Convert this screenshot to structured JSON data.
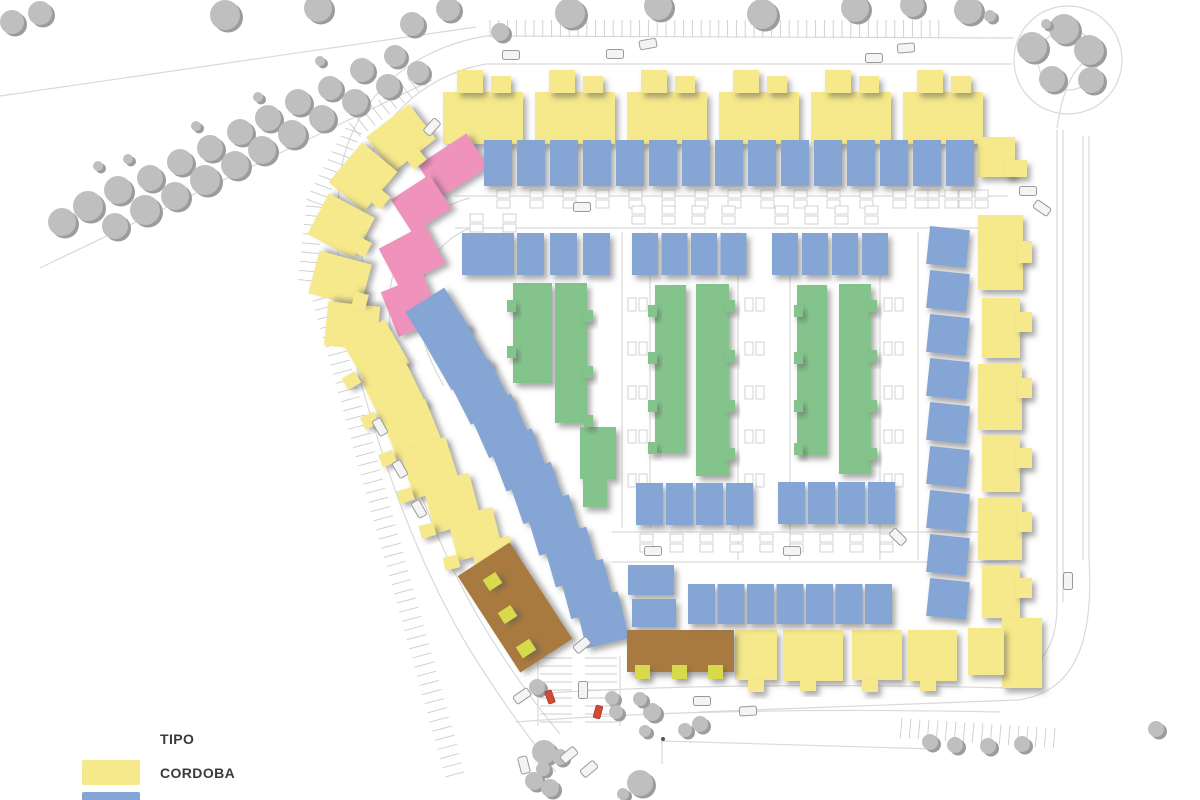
{
  "legend": {
    "title": "TIPO",
    "items": [
      {
        "label": "CORDOBA",
        "color": "#f6e98b"
      },
      {
        "label": "GRANADA",
        "color": "#85a6d4"
      }
    ]
  },
  "palette": {
    "c": "#f6e98b",
    "g": "#85a6d4",
    "v": "#84c48c",
    "p": "#ef93bd",
    "b": "#a87a40",
    "a": "#d6da4c",
    "rojo": "#d14a38",
    "tree": "#bfbfbf",
    "tree_shadow": "#9c9c9c",
    "road": "#d9d9d9",
    "tick": "#cccccc",
    "marker": "#c8c8c8"
  },
  "types": {
    "c": "cordoba-house",
    "g": "granada-house",
    "v": "green-rowhouse",
    "p": "pink-house",
    "b": "brown-community-building",
    "a": "lime-accent"
  },
  "map": {
    "roads": [
      {
        "d": "M 0,96 L 476,27"
      },
      {
        "d": "M 40,268 L 432,80"
      },
      {
        "d": "M 486,36 C 402,50 348,108 340,178 C 334,240 338,300 358,372 C 382,460 418,565 470,650 C 496,692 524,732 556,772"
      },
      {
        "d": "M 486,64 C 420,76 372,124 364,186 C 358,244 362,298 380,366 C 402,450 436,548 486,630 C 508,666 530,698 560,734"
      },
      {
        "d": "M 486,36 L 1014,38"
      },
      {
        "d": "M 486,64 L 1012,64"
      },
      {
        "c": [
          1068,
          60,
          54
        ]
      },
      {
        "c": [
          1068,
          60,
          30
        ]
      },
      {
        "d": "M 1057,128 C 1062,95 1070,75 1082,64"
      },
      {
        "d": "M 1057,130 L 1057,600"
      },
      {
        "d": "M 1063,130 L 1063,602"
      },
      {
        "d": "M 1083,136 L 1083,560"
      },
      {
        "d": "M 1089,136 L 1089,558"
      },
      {
        "d": "M 1057,600 C 1058,640 1046,668 1008,676"
      },
      {
        "d": "M 1089,558 C 1094,640 1076,692 1018,700 L 700,712"
      },
      {
        "d": "M 520,695 C 640,686 800,683 1008,688"
      },
      {
        "d": "M 516,722 C 640,712 800,708 1000,712"
      },
      {
        "d": "M 470,198 C 424,210 396,246 390,290 C 386,330 396,370 416,406"
      },
      {
        "d": "M 476,226 C 444,236 424,262 420,296 C 417,328 426,356 444,386"
      },
      {
        "d": "M 455,196 L 1008,196"
      },
      {
        "d": "M 455,228 L 1008,228"
      },
      {
        "d": "M 622,232 L 622,528"
      },
      {
        "d": "M 650,232 L 650,528"
      },
      {
        "d": "M 738,232 L 738,560"
      },
      {
        "d": "M 790,232 L 790,560"
      },
      {
        "d": "M 880,232 L 880,560"
      },
      {
        "d": "M 918,232 L 918,560"
      },
      {
        "d": "M 612,532 L 1008,532"
      },
      {
        "d": "M 612,562 L 1008,562"
      },
      {
        "d": "M 662,764 L 662,741 L 935,749"
      },
      {
        "d": "M 538,656 L 538,726"
      },
      {
        "d": "M 620,656 L 620,726"
      }
    ],
    "parking": [
      [
        490,
        20,
        52,
        8.8,
        0,
        17,
        90
      ],
      [
        415,
        72,
        10,
        -7.3,
        5.6,
        18,
        52
      ],
      [
        345,
        128,
        10,
        -4.3,
        7.9,
        18,
        20
      ],
      [
        306,
        206,
        9,
        -1.0,
        9.2,
        18,
        5
      ],
      [
        310,
        292,
        54,
        2.55,
        9.15,
        20,
        -15
      ],
      [
        902,
        718,
        18,
        9,
        0.6,
        20,
        95
      ],
      [
        540,
        658,
        9,
        0,
        8,
        32,
        0
      ],
      [
        585,
        658,
        9,
        0,
        8,
        32,
        0
      ]
    ],
    "markers": [
      [
        497,
        190,
        15,
        33,
        "h"
      ],
      [
        470,
        214,
        2,
        33,
        "h"
      ],
      [
        632,
        206,
        4,
        30,
        "h"
      ],
      [
        775,
        206,
        4,
        30,
        "h"
      ],
      [
        628,
        298,
        5,
        44,
        "v"
      ],
      [
        745,
        298,
        5,
        44,
        "v"
      ],
      [
        884,
        298,
        5,
        44,
        "v"
      ],
      [
        640,
        534,
        9,
        30,
        "h"
      ],
      [
        915,
        190,
        3,
        30,
        "h"
      ]
    ],
    "rows": [
      {
        "t": "g",
        "x": 484,
        "y": 140,
        "w": 28,
        "h": 46,
        "n": 15,
        "px": 33
      },
      {
        "t": "g",
        "x": 517,
        "y": 233,
        "w": 27,
        "h": 42,
        "n": 3,
        "px": 33
      },
      {
        "t": "g",
        "x": 632,
        "y": 233,
        "w": 26,
        "h": 42,
        "n": 4,
        "px": 29.5
      },
      {
        "t": "g",
        "x": 772,
        "y": 233,
        "w": 26,
        "h": 42,
        "n": 4,
        "px": 30
      },
      {
        "t": "g",
        "x": 636,
        "y": 483,
        "w": 27,
        "h": 42,
        "n": 4,
        "px": 30
      },
      {
        "t": "g",
        "x": 778,
        "y": 482,
        "w": 27,
        "h": 42,
        "n": 4,
        "px": 30
      },
      {
        "t": "g",
        "x": 688,
        "y": 584,
        "w": 27,
        "h": 40,
        "n": 7,
        "px": 29.5
      },
      {
        "t": "g",
        "x": 928,
        "y": 228,
        "w": 40,
        "h": 38,
        "n": 9,
        "py": 44,
        "rot": 6
      }
    ],
    "buildings": [
      [
        "c",
        443,
        92,
        80,
        52
      ],
      [
        "c",
        457,
        70,
        26,
        23
      ],
      [
        "c",
        491,
        76,
        20,
        17
      ],
      [
        "c",
        535,
        92,
        80,
        52
      ],
      [
        "c",
        549,
        70,
        26,
        23
      ],
      [
        "c",
        583,
        76,
        20,
        17
      ],
      [
        "c",
        627,
        92,
        80,
        52
      ],
      [
        "c",
        641,
        70,
        26,
        23
      ],
      [
        "c",
        675,
        76,
        20,
        17
      ],
      [
        "c",
        719,
        92,
        80,
        52
      ],
      [
        "c",
        733,
        70,
        26,
        23
      ],
      [
        "c",
        767,
        76,
        20,
        17
      ],
      [
        "c",
        811,
        92,
        80,
        52
      ],
      [
        "c",
        825,
        70,
        26,
        23
      ],
      [
        "c",
        859,
        76,
        20,
        17
      ],
      [
        "c",
        903,
        92,
        80,
        52
      ],
      [
        "c",
        917,
        70,
        26,
        23
      ],
      [
        "c",
        951,
        76,
        20,
        17
      ],
      [
        "c",
        978,
        137,
        37,
        40
      ],
      [
        "c",
        1005,
        160,
        22,
        17
      ],
      [
        "c",
        978,
        215,
        45,
        75
      ],
      [
        "c",
        1018,
        241,
        14,
        22
      ],
      [
        "c",
        982,
        298,
        38,
        60
      ],
      [
        "c",
        1016,
        312,
        16,
        20
      ],
      [
        "c",
        978,
        364,
        44,
        66
      ],
      [
        "c",
        1018,
        378,
        14,
        20
      ],
      [
        "c",
        982,
        436,
        38,
        56
      ],
      [
        "c",
        1016,
        448,
        16,
        20
      ],
      [
        "c",
        978,
        498,
        44,
        62
      ],
      [
        "c",
        1018,
        512,
        14,
        20
      ],
      [
        "c",
        982,
        566,
        38,
        52
      ],
      [
        "c",
        1016,
        578,
        16,
        20
      ],
      [
        "c",
        1002,
        618,
        40,
        70
      ],
      [
        "c",
        735,
        630,
        42,
        50
      ],
      [
        "c",
        783,
        630,
        60,
        51
      ],
      [
        "c",
        852,
        630,
        50,
        50
      ],
      [
        "c",
        908,
        630,
        49,
        51
      ],
      [
        "c",
        968,
        628,
        36,
        47
      ],
      [
        "c",
        748,
        680,
        16,
        12
      ],
      [
        "c",
        800,
        681,
        16,
        10
      ],
      [
        "c",
        862,
        680,
        16,
        12
      ],
      [
        "c",
        920,
        681,
        16,
        10
      ],
      [
        "p",
        424,
        146,
        58,
        40,
        -33
      ],
      [
        "p",
        398,
        184,
        46,
        40,
        -33
      ],
      [
        "p",
        386,
        234,
        52,
        44,
        -28
      ],
      [
        "p",
        388,
        282,
        46,
        48,
        -22
      ],
      [
        "c",
        374,
        116,
        54,
        44,
        -38
      ],
      [
        "c",
        337,
        154,
        52,
        46,
        -50
      ],
      [
        "c",
        318,
        200,
        46,
        52,
        -62
      ],
      [
        "c",
        318,
        252,
        44,
        54,
        -75
      ],
      [
        "c",
        330,
        300,
        44,
        52,
        -84
      ],
      [
        "c",
        408,
        152,
        16,
        14,
        -38
      ],
      [
        "c",
        372,
        192,
        16,
        14,
        -50
      ],
      [
        "c",
        354,
        240,
        16,
        14,
        -62
      ],
      [
        "c",
        352,
        294,
        16,
        14,
        -75
      ],
      [
        "c",
        364,
        342,
        16,
        14,
        -84
      ],
      [
        "c",
        352,
        328,
        48,
        50,
        -30
      ],
      [
        "c",
        370,
        368,
        48,
        50,
        -26
      ],
      [
        "c",
        388,
        406,
        48,
        50,
        -22
      ],
      [
        "c",
        406,
        443,
        48,
        50,
        -18
      ],
      [
        "c",
        428,
        478,
        48,
        50,
        -15
      ],
      [
        "c",
        452,
        512,
        46,
        44,
        -14
      ],
      [
        "c",
        474,
        540,
        40,
        36,
        -14
      ],
      [
        "c",
        344,
        374,
        15,
        13,
        -30
      ],
      [
        "c",
        362,
        414,
        15,
        13,
        -26
      ],
      [
        "c",
        380,
        452,
        15,
        13,
        -22
      ],
      [
        "c",
        398,
        489,
        15,
        13,
        -18
      ],
      [
        "c",
        420,
        524,
        15,
        13,
        -15
      ],
      [
        "c",
        444,
        556,
        15,
        13,
        -14
      ],
      [
        "g",
        415,
        296,
        46,
        50,
        -32
      ],
      [
        "g",
        436,
        332,
        46,
        50,
        -30
      ],
      [
        "g",
        457,
        367,
        46,
        50,
        -27
      ],
      [
        "g",
        477,
        401,
        46,
        50,
        -24
      ],
      [
        "g",
        496,
        435,
        46,
        50,
        -21
      ],
      [
        "g",
        514,
        468,
        46,
        50,
        -19
      ],
      [
        "g",
        531,
        500,
        46,
        50,
        -17
      ],
      [
        "g",
        548,
        532,
        46,
        50,
        -16
      ],
      [
        "g",
        564,
        564,
        46,
        50,
        -15
      ],
      [
        "g",
        580,
        596,
        44,
        48,
        -14
      ],
      [
        "g",
        462,
        233,
        52,
        42
      ],
      [
        "g",
        628,
        565,
        46,
        30
      ],
      [
        "g",
        632,
        599,
        44,
        28
      ],
      [
        "v",
        513,
        283,
        39,
        100
      ],
      [
        "v",
        555,
        283,
        32,
        140
      ],
      [
        "v",
        580,
        427,
        36,
        52
      ],
      [
        "v",
        583,
        479,
        24,
        28
      ],
      [
        "v",
        655,
        285,
        31,
        168
      ],
      [
        "v",
        696,
        284,
        33,
        192
      ],
      [
        "v",
        797,
        285,
        30,
        170
      ],
      [
        "v",
        839,
        284,
        32,
        190
      ],
      [
        "b",
        484,
        550,
        62,
        115,
        -33
      ],
      [
        "b",
        627,
        630,
        107,
        42
      ],
      [
        "a",
        485,
        575,
        15,
        13,
        -33
      ],
      [
        "a",
        500,
        608,
        15,
        13,
        -33
      ],
      [
        "a",
        518,
        642,
        16,
        13,
        -33
      ],
      [
        "a",
        635,
        665,
        15,
        14,
        0
      ],
      [
        "a",
        672,
        665,
        15,
        14,
        0
      ],
      [
        "a",
        708,
        665,
        15,
        14,
        0
      ]
    ],
    "bumps": [
      [
        507,
        300
      ],
      [
        507,
        346
      ],
      [
        584,
        310
      ],
      [
        584,
        366
      ],
      [
        584,
        415
      ],
      [
        648,
        305
      ],
      [
        648,
        352
      ],
      [
        648,
        400
      ],
      [
        648,
        442
      ],
      [
        726,
        300
      ],
      [
        726,
        350
      ],
      [
        726,
        400
      ],
      [
        726,
        448
      ],
      [
        794,
        305
      ],
      [
        794,
        352
      ],
      [
        794,
        400
      ],
      [
        794,
        443
      ],
      [
        868,
        300
      ],
      [
        868,
        350
      ],
      [
        868,
        400
      ],
      [
        868,
        448
      ]
    ],
    "trees": [
      [
        12,
        22,
        12
      ],
      [
        40,
        13,
        12
      ],
      [
        62,
        222,
        14
      ],
      [
        88,
        206,
        15
      ],
      [
        115,
        226,
        13
      ],
      [
        118,
        190,
        14
      ],
      [
        145,
        210,
        15
      ],
      [
        150,
        178,
        13
      ],
      [
        175,
        196,
        14
      ],
      [
        180,
        162,
        13
      ],
      [
        205,
        180,
        15
      ],
      [
        210,
        148,
        13
      ],
      [
        235,
        165,
        14
      ],
      [
        240,
        132,
        13
      ],
      [
        262,
        150,
        14
      ],
      [
        268,
        118,
        13
      ],
      [
        292,
        134,
        14
      ],
      [
        298,
        102,
        13
      ],
      [
        322,
        118,
        13
      ],
      [
        330,
        88,
        12
      ],
      [
        355,
        102,
        13
      ],
      [
        362,
        70,
        12
      ],
      [
        388,
        86,
        12
      ],
      [
        395,
        56,
        11
      ],
      [
        418,
        72,
        11
      ],
      [
        128,
        159,
        5
      ],
      [
        196,
        126,
        5
      ],
      [
        258,
        97,
        5
      ],
      [
        320,
        61,
        5
      ],
      [
        98,
        166,
        5
      ],
      [
        225,
        15,
        15
      ],
      [
        318,
        8,
        14
      ],
      [
        412,
        24,
        12
      ],
      [
        448,
        9,
        12
      ],
      [
        500,
        32,
        9
      ],
      [
        570,
        13,
        15
      ],
      [
        658,
        6,
        14
      ],
      [
        762,
        14,
        15
      ],
      [
        855,
        8,
        14
      ],
      [
        912,
        5,
        12
      ],
      [
        968,
        10,
        14
      ],
      [
        990,
        16,
        6
      ],
      [
        1032,
        47,
        15
      ],
      [
        1064,
        29,
        15
      ],
      [
        1089,
        50,
        15
      ],
      [
        1052,
        79,
        13
      ],
      [
        1091,
        80,
        13
      ],
      [
        1046,
        24,
        5
      ],
      [
        612,
        698,
        7
      ],
      [
        652,
        712,
        9
      ],
      [
        700,
        724,
        8
      ],
      [
        645,
        731,
        6
      ],
      [
        537,
        687,
        8
      ],
      [
        544,
        752,
        12
      ],
      [
        543,
        769,
        7
      ],
      [
        534,
        781,
        9
      ],
      [
        640,
        783,
        13
      ],
      [
        623,
        794,
        6
      ],
      [
        640,
        699,
        7
      ],
      [
        616,
        712,
        7
      ],
      [
        685,
        730,
        7
      ],
      [
        560,
        757,
        8
      ],
      [
        550,
        788,
        9
      ],
      [
        930,
        742,
        8
      ],
      [
        955,
        745,
        8
      ],
      [
        988,
        746,
        8
      ],
      [
        1022,
        744,
        8
      ],
      [
        1156,
        729,
        8
      ]
    ],
    "cars": [
      [
        511,
        55,
        0
      ],
      [
        615,
        54,
        0
      ],
      [
        648,
        44,
        -10
      ],
      [
        874,
        58,
        0
      ],
      [
        906,
        48,
        -5
      ],
      [
        582,
        207,
        0
      ],
      [
        653,
        551,
        0
      ],
      [
        792,
        551,
        0
      ],
      [
        898,
        537,
        45
      ],
      [
        380,
        427,
        60
      ],
      [
        400,
        469,
        60
      ],
      [
        419,
        509,
        60
      ],
      [
        702,
        701,
        0
      ],
      [
        748,
        711,
        -3
      ],
      [
        1068,
        581,
        90
      ],
      [
        432,
        127,
        -48
      ],
      [
        583,
        690,
        90
      ],
      [
        582,
        645,
        -40
      ],
      [
        522,
        696,
        -35
      ],
      [
        569,
        755,
        -40
      ],
      [
        589,
        769,
        -40
      ],
      [
        524,
        765,
        75
      ],
      [
        1028,
        191,
        0
      ],
      [
        1042,
        208,
        35
      ]
    ],
    "red_vehicles": [
      [
        550,
        697,
        -20
      ],
      [
        598,
        712,
        15
      ]
    ],
    "dots": [
      [
        663,
        739
      ]
    ]
  }
}
